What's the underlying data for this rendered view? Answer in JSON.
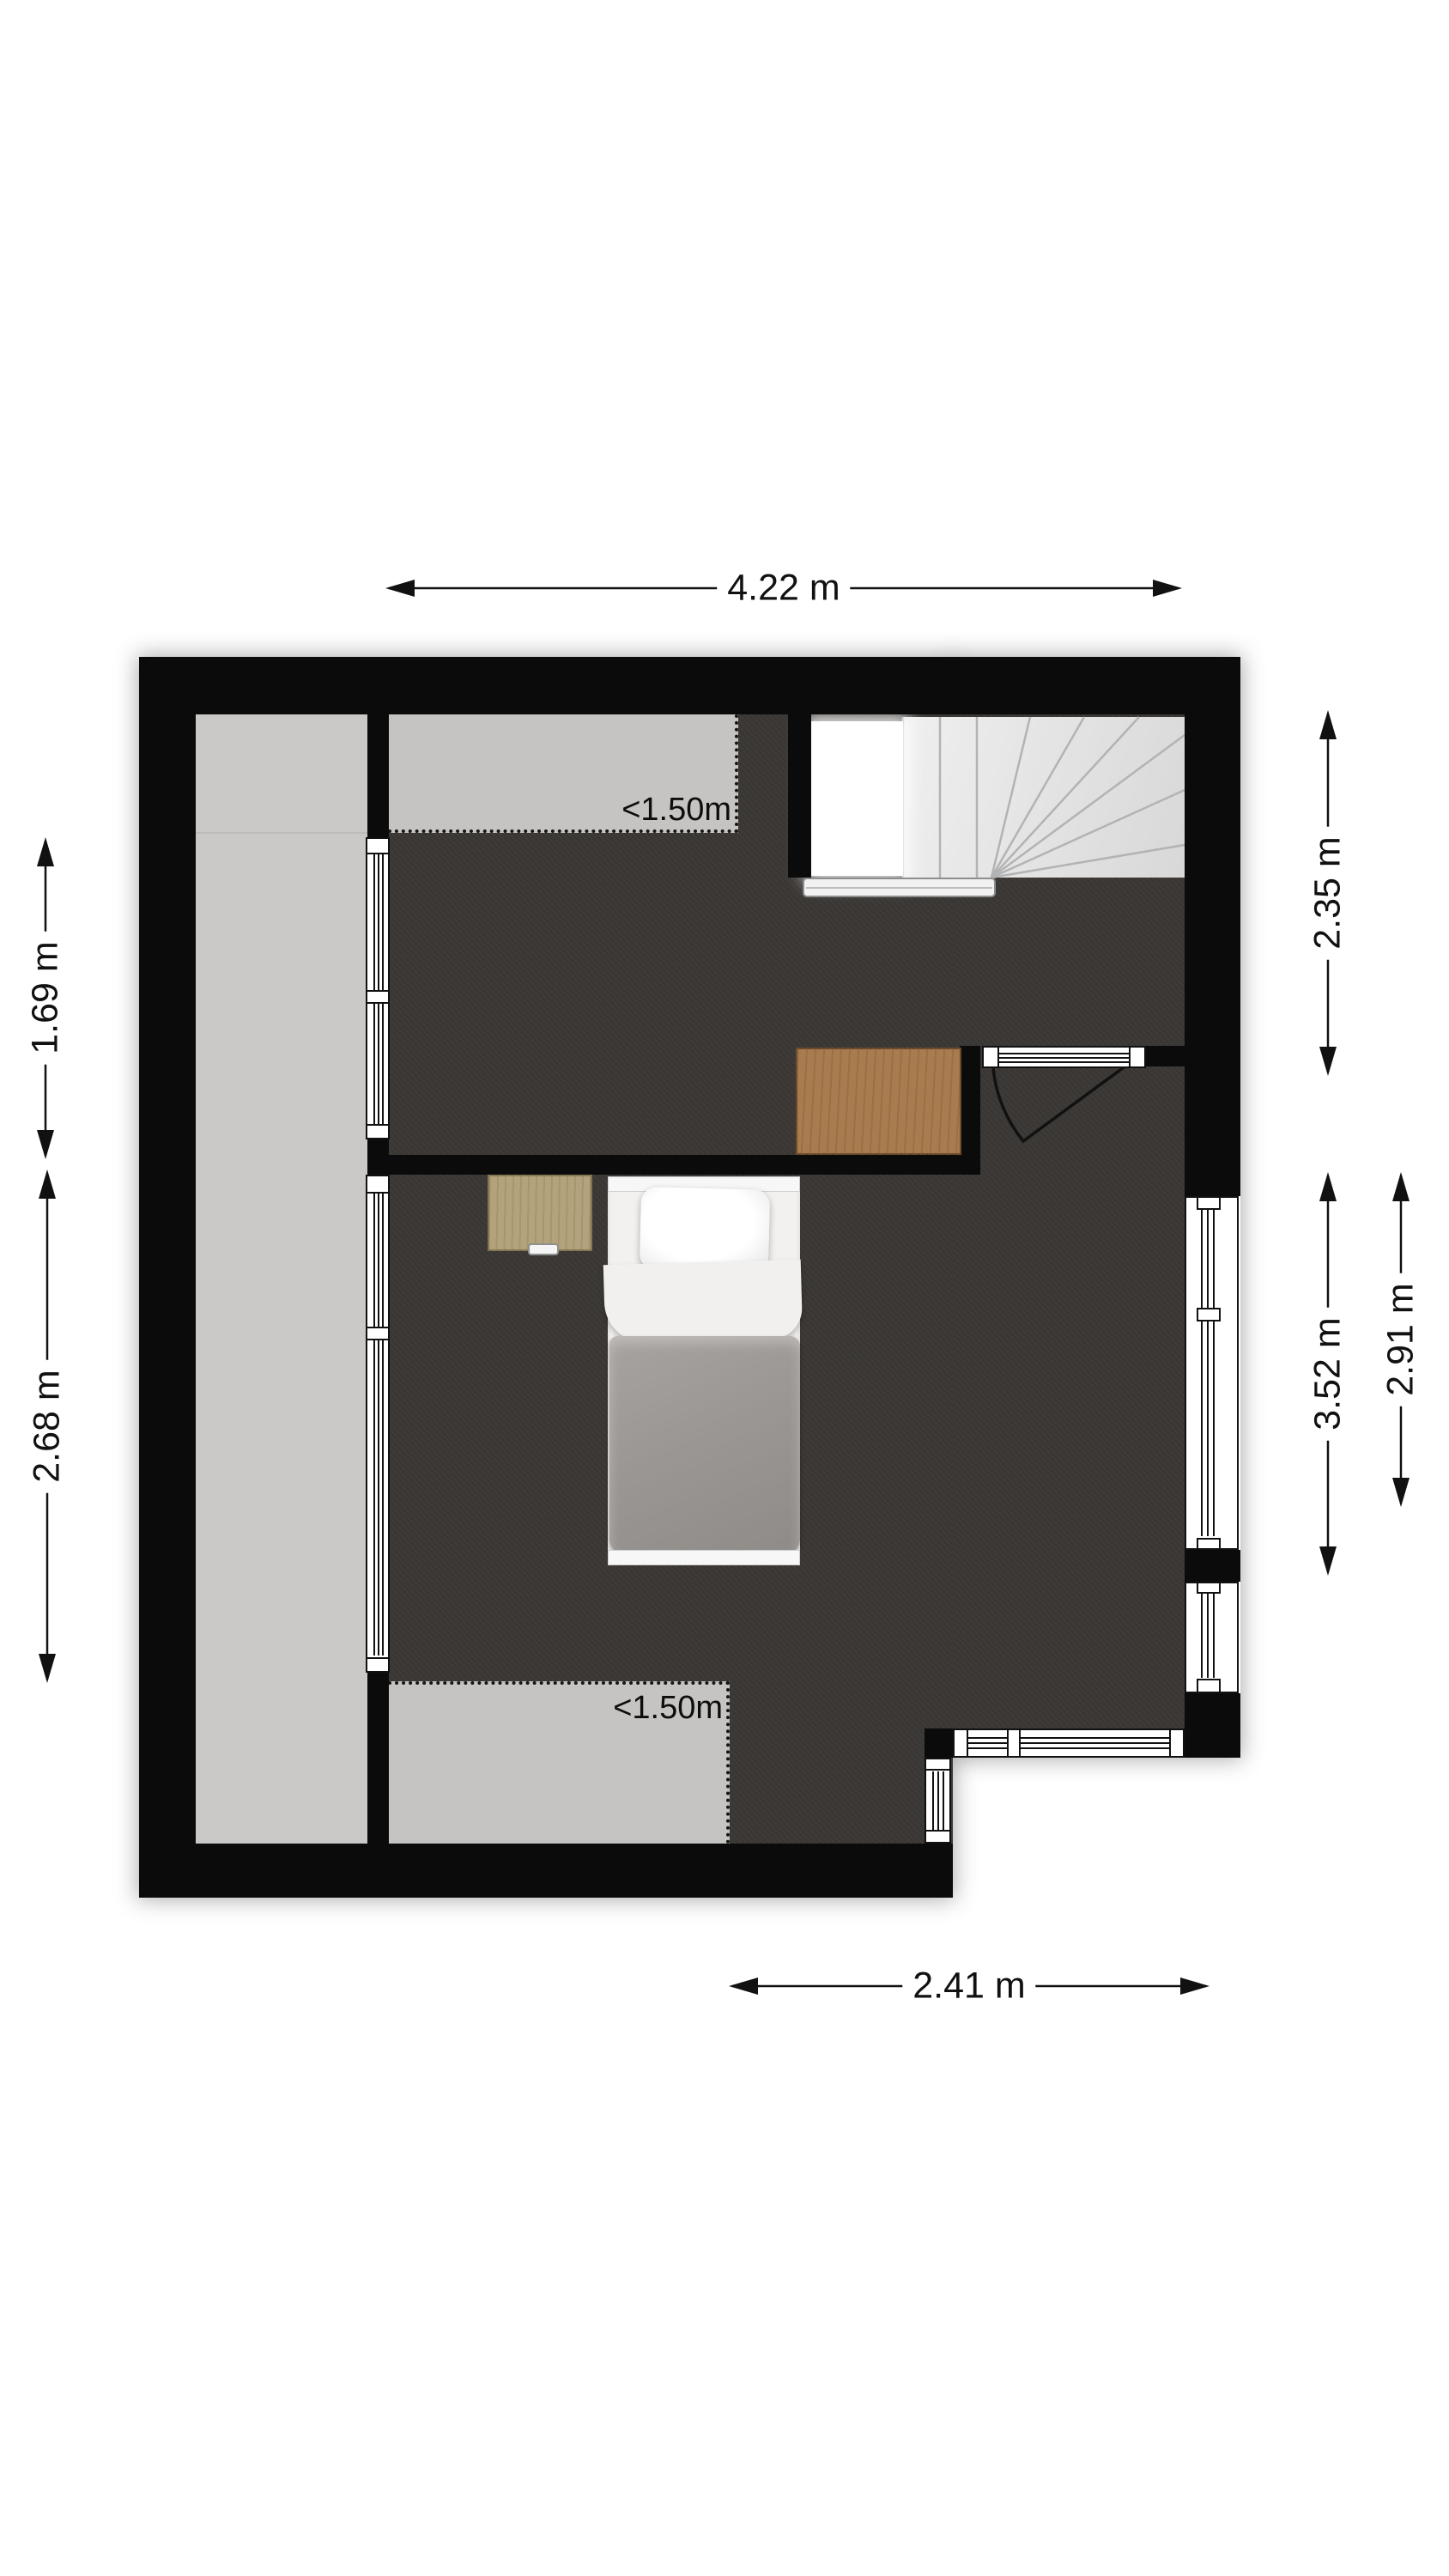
{
  "floorplan": {
    "type": "attic-floor-plan",
    "dimensions": {
      "top": "4.22 m",
      "bottom": "2.41 m",
      "left_upper": "1.69 m",
      "left_lower": "2.68 m",
      "right_upper": "2.35 m",
      "right_inner": "3.52 m",
      "right_outer": "2.91 m"
    },
    "area_labels": {
      "top_low_ceiling": "<1.50m",
      "bottom_low_ceiling": "<1.50m"
    },
    "colors": {
      "wall": "#0b0b0b",
      "floor": "#3a3734",
      "low_ceiling_area": "#c5c4c2",
      "side_area": "#cac9c7",
      "stairs": "#e3e3e3",
      "large_desk_wood": "#a87c4e",
      "small_desk_wood": "#b2a37d",
      "bed_duvet": "#9b9794",
      "bed_linen": "#f1f0ee"
    },
    "elements": {
      "staircase": "winder-staircase-with-void",
      "door": "hinged-door-top-right",
      "bed": "single-bed",
      "large_desk": "wood-desk",
      "small_desk": "small-side-desk",
      "windows": "left-knee-wall, right-wall, bottom-right-wall"
    }
  }
}
